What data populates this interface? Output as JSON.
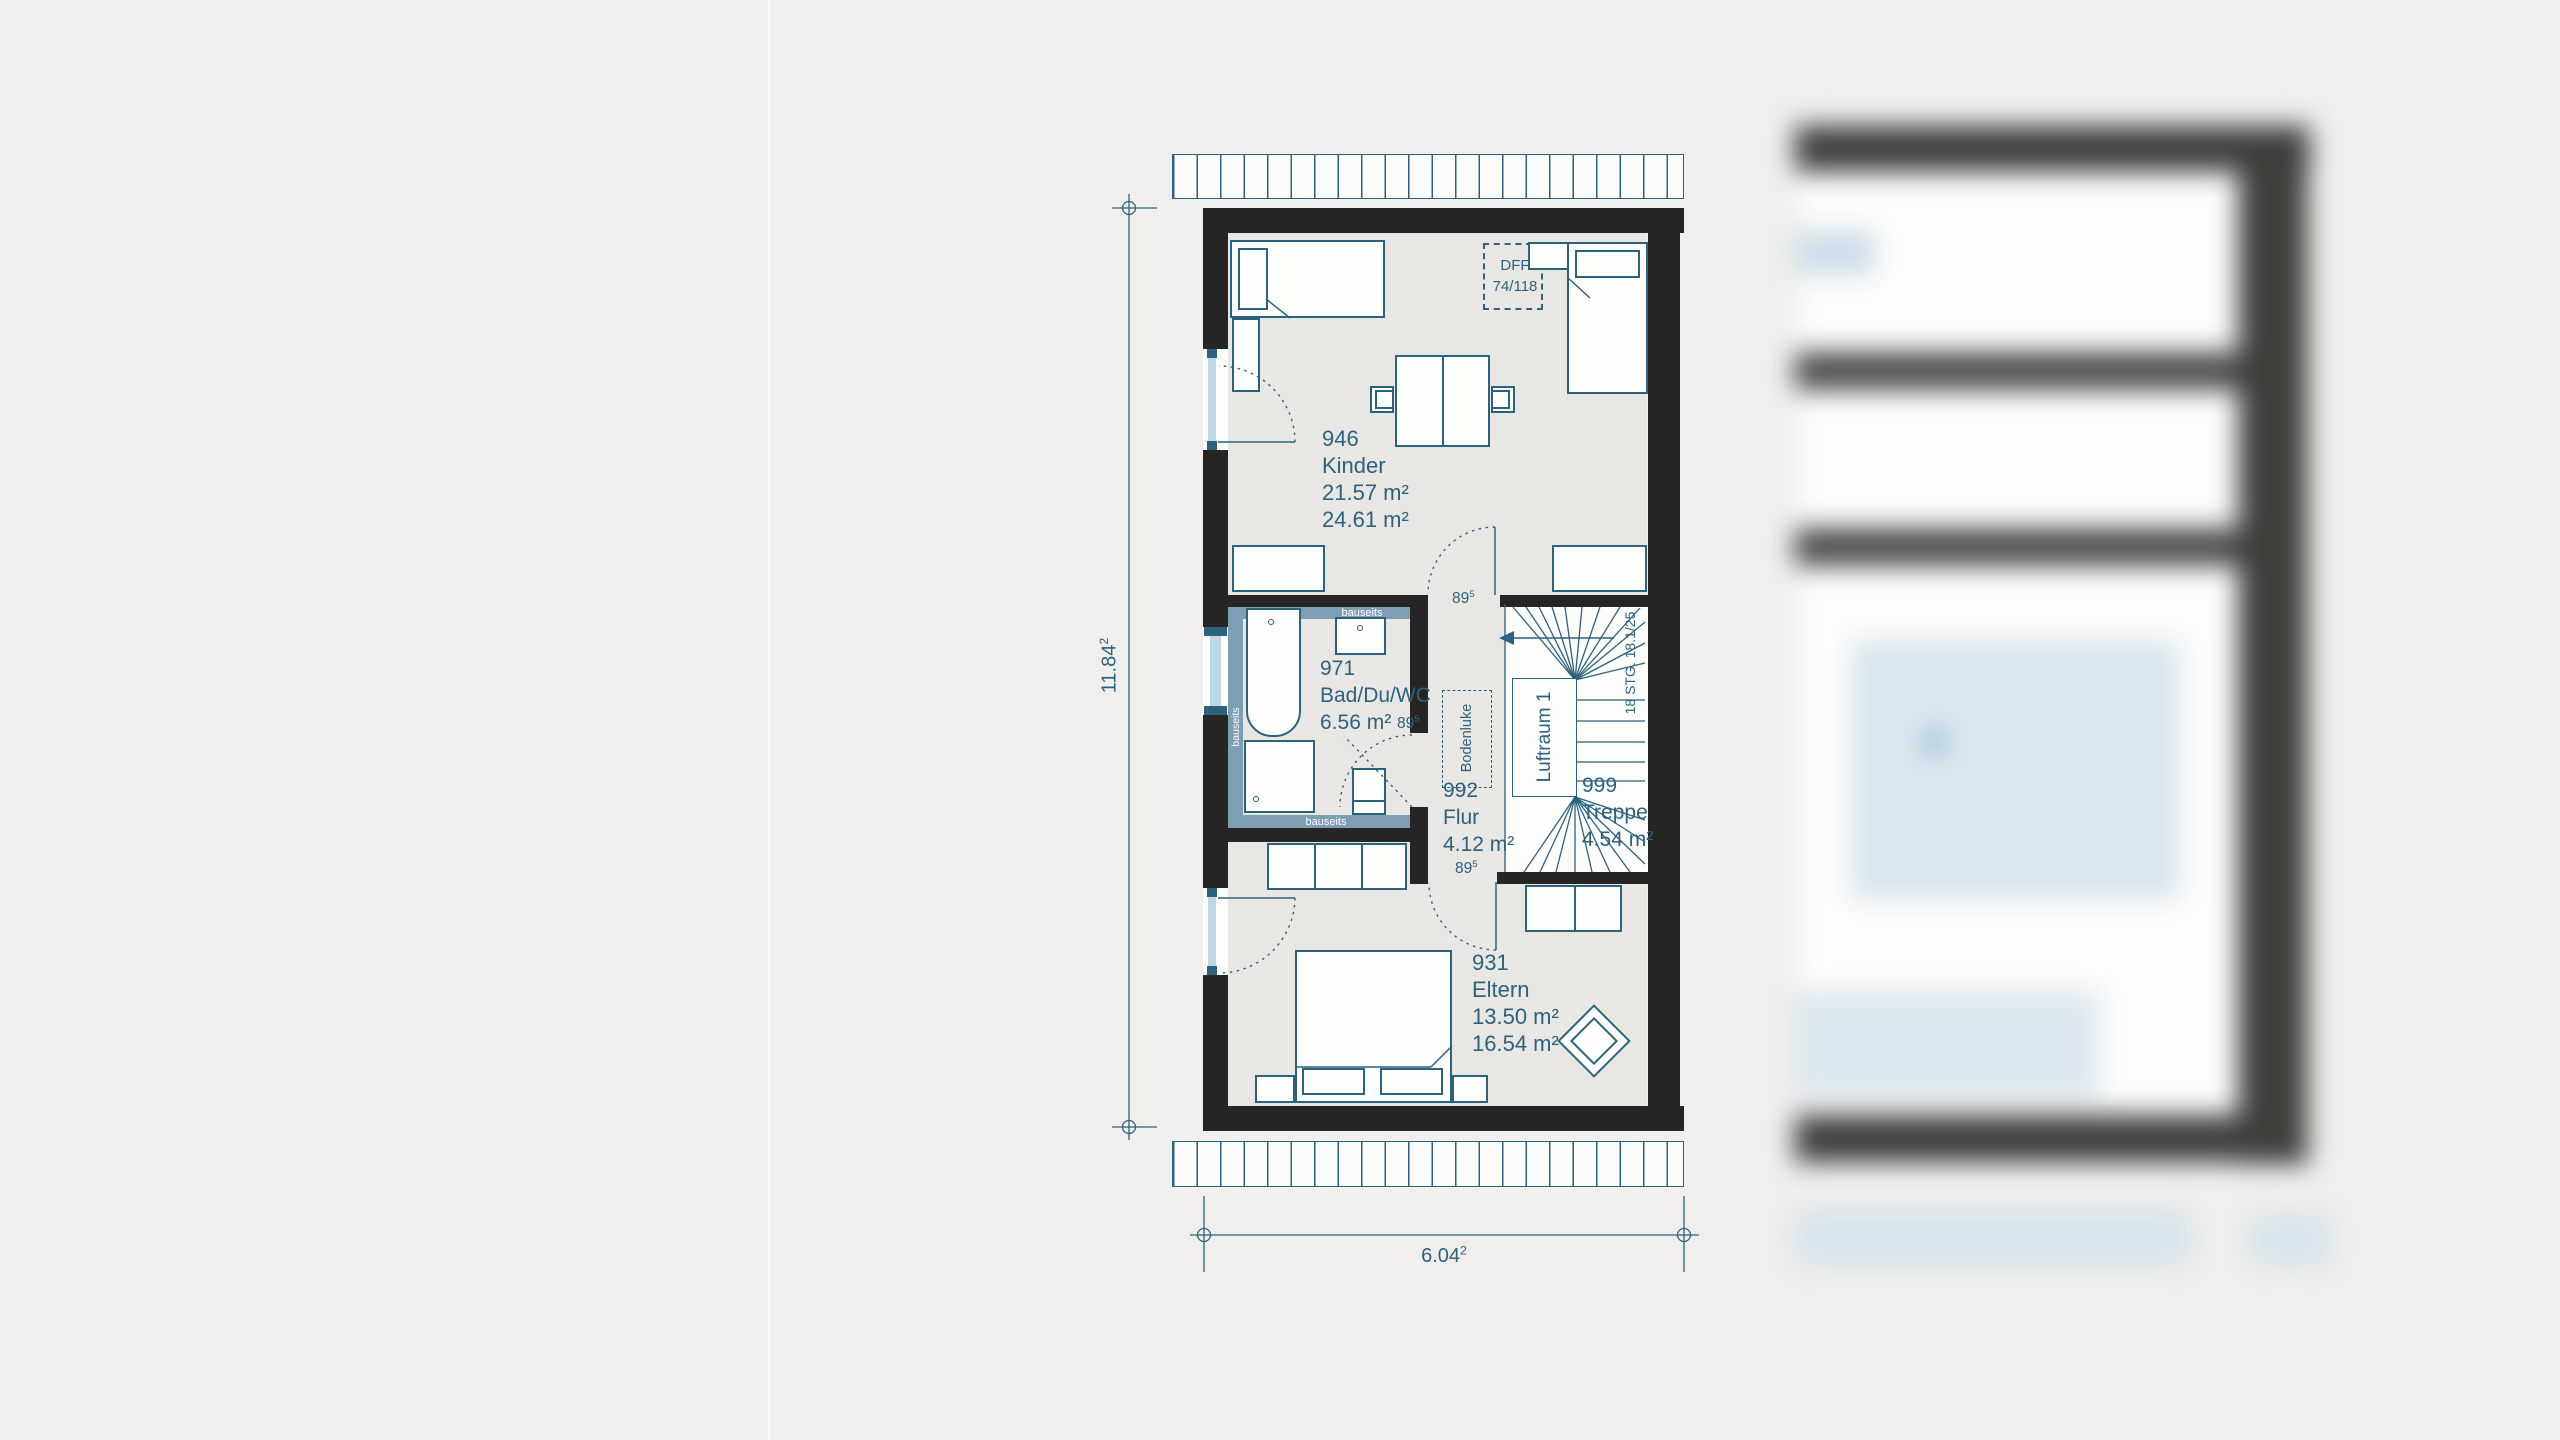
{
  "page": {
    "background": "#f0efed"
  },
  "floorplan": {
    "rooms": [
      {
        "number": "946",
        "name": "Kinder",
        "areas": [
          "21.57 m²",
          "24.61 m²"
        ]
      },
      {
        "number": "971",
        "name": "Bad/Du/WC",
        "areas": [
          "6.56 m²"
        ]
      },
      {
        "number": "992",
        "name": "Flur",
        "areas": [
          "4.12 m²"
        ]
      },
      {
        "number": "999",
        "name": "Treppe",
        "areas": [
          "4.54 m²"
        ]
      },
      {
        "number": "931",
        "name": "Eltern",
        "areas": [
          "13.50 m²",
          "16.54 m²"
        ]
      }
    ],
    "labels": {
      "roof_window_line1": "DFF",
      "roof_window_line2": "74/118",
      "floor_hatch": "Bodenluke",
      "air_space": "Luftraum 1",
      "stair_note": "18 STG. 18.1/25",
      "on_site": "bauseits",
      "door_width": {
        "value": "89",
        "sup": "5"
      }
    },
    "dimensions": {
      "vertical": {
        "value": "11.84",
        "sup": "2"
      },
      "horizontal": {
        "value": "6.04",
        "sup": "2"
      }
    },
    "colors": {
      "wall": "#262523",
      "line": "#2b627e",
      "text": "#2b627e",
      "floor": "#e9e7e3",
      "on_site_strip": "#7d9eb3",
      "window_pane": "#bdd7e5",
      "background": "#f0efed"
    }
  }
}
